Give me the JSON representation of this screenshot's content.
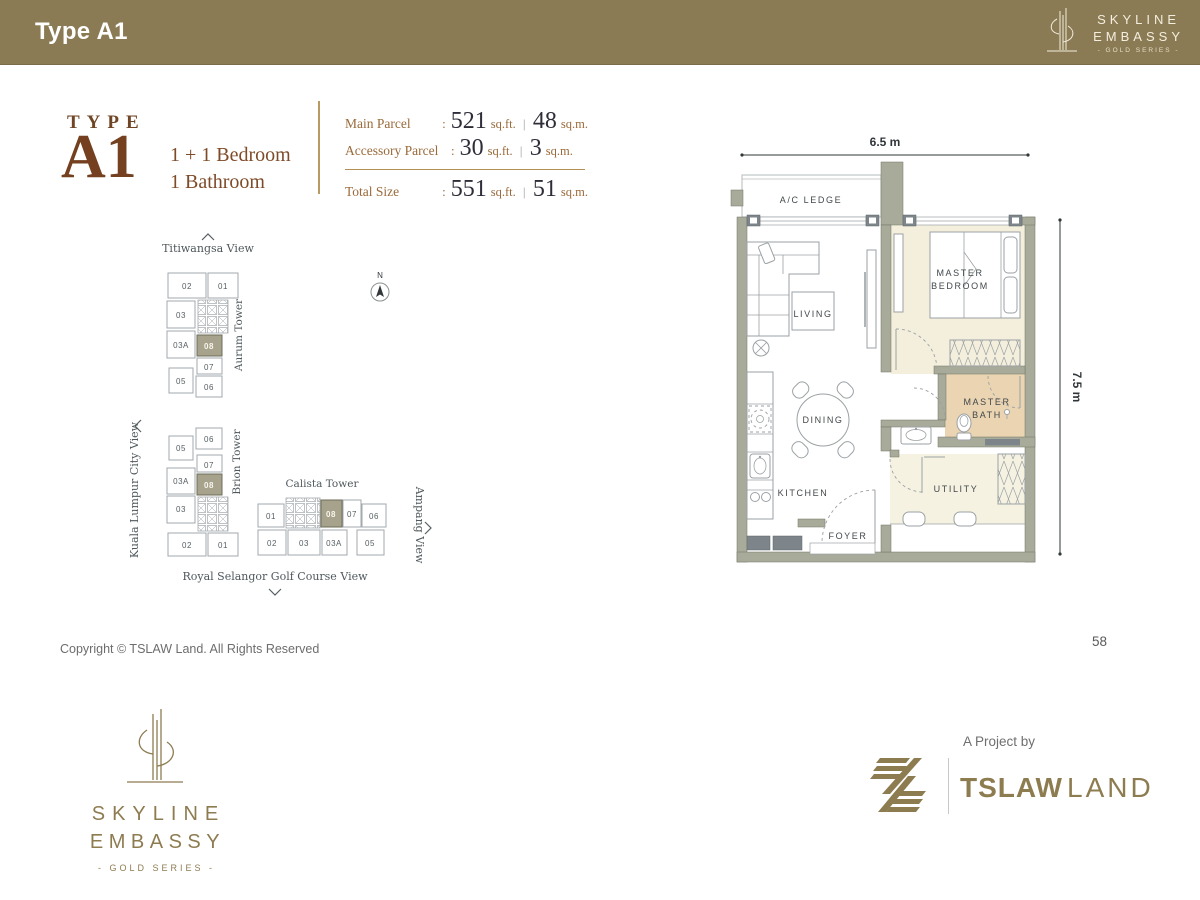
{
  "header": {
    "title": "Type A1",
    "logo": {
      "name1": "SKYLINE",
      "name2": "EMBASSY",
      "series": "- GOLD SERIES -"
    }
  },
  "summary": {
    "type_label": "TYPE",
    "type_code": "A1",
    "line1": "1 + 1 Bedroom",
    "line2": "1 Bathroom"
  },
  "parcel": {
    "rows": [
      {
        "label": "Main Parcel",
        "colon": ":",
        "sqft": "521",
        "sqft_unit": "sq.ft.",
        "bar": "|",
        "sqm": "48",
        "sqm_unit": "sq.m."
      },
      {
        "label": "Accessory Parcel",
        "colon": ":",
        "sqft": "30",
        "sqft_unit": "sq.ft.",
        "bar": "|",
        "sqm": "3",
        "sqm_unit": "sq.m."
      },
      {
        "label": "Total Size",
        "colon": ":",
        "sqft": "551",
        "sqft_unit": "sq.ft.",
        "bar": "|",
        "sqm": "51",
        "sqm_unit": "sq.m."
      }
    ]
  },
  "site_plan": {
    "compass": "N",
    "views": {
      "north": "Titiwangsa View",
      "west": "Kuala Lumpur City View",
      "east": "Ampang View",
      "south": "Royal Selangor Golf Course View"
    },
    "towers": [
      {
        "name": "Aurum Tower",
        "units": [
          "02",
          "01",
          "03",
          "03A",
          "08",
          "07",
          "05",
          "06"
        ]
      },
      {
        "name": "Brion Tower",
        "units": [
          "06",
          "05",
          "07",
          "03A",
          "08",
          "03",
          "02",
          "01"
        ]
      },
      {
        "name": "Calista Tower",
        "units": [
          "01",
          "08",
          "07",
          "06",
          "02",
          "03",
          "03A",
          "05"
        ]
      }
    ],
    "highlighted_unit": "08"
  },
  "floor_plan": {
    "width_dim": "6.5 m",
    "height_dim": "7.5 m",
    "rooms": {
      "ac_ledge": "A/C LEDGE",
      "living": "LIVING",
      "master_bedroom_1": "MASTER",
      "master_bedroom_2": "BEDROOM",
      "dining": "DINING",
      "master_bath_1": "MASTER",
      "master_bath_2": "BATH",
      "kitchen": "KITCHEN",
      "utility": "UTILITY",
      "foyer": "FOYER"
    }
  },
  "footer": {
    "copyright": "Copyright © TSLAW Land. All Rights Reserved",
    "page_number": "58",
    "brand": {
      "name1": "SKYLINE",
      "name2": "EMBASSY",
      "series": "- GOLD SERIES -"
    },
    "project": {
      "prefix": "A Project by",
      "developer_bold": "TSLAW",
      "developer_light": "LAND"
    }
  },
  "colors": {
    "header_bg": "#8b7b55",
    "gold": "#8d7c50",
    "brown": "#74401f",
    "wall": "#a8ab99",
    "unit_highlight": "#a7a28b",
    "bedroom_floor": "#f4efdc",
    "bath_floor": "#ead4b2"
  }
}
